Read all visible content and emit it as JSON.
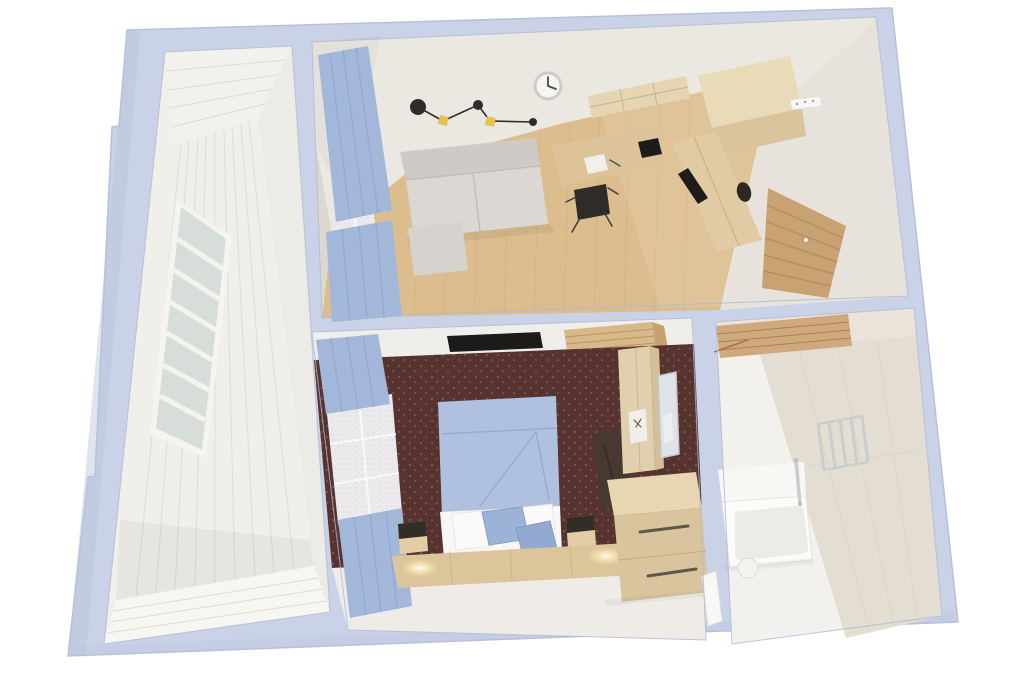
{
  "image": {
    "width": 1024,
    "height": 688,
    "kind": "3d-floorplan-dollhouse-render",
    "background": "#ffffff"
  },
  "colors": {
    "page_bg": "#ffffff",
    "outer_wall": "#c9d2e7",
    "outer_wall_shade": "#b9c3da",
    "hole_outline": "#aeb9d2",
    "balcony_base": "#f1efea",
    "balcony_ceiling": "#f3f1ed",
    "balcony_east_wall": "#ecebe6",
    "balcony_wall": "#f1efea",
    "balcony_floor": "#f7f6f3",
    "plank_line": "#dcd8d1",
    "window_frame": "#f5f4f1",
    "window_glass": "#d7ddd8",
    "window_slat": "#f4f3f0",
    "living_wall": "#ebe8e2",
    "living_wall_shade": "#dcd8d0",
    "living_east_wall": "#e7e3dc",
    "floor_wood": "#dcbd8e",
    "floor_line": "#c8a678",
    "sofa_back": "#cfcac6",
    "sofa_seat": "#dbd7d3",
    "sofa_shadow": "#bdb8b4",
    "ottoman": "#d6d2ce",
    "lamp_dark": "#2e2d2b",
    "lamp_yellow": "#e6c14b",
    "clock_face": "#f6f5f2",
    "clock_ring": "#cfccc6",
    "desk_wood": "#ddc399",
    "chair_dark": "#2f2b27",
    "item_black": "#1d1c1b",
    "notebook_white": "#f1f0ec",
    "shelf_wood": "#e6d5b2",
    "cabinet_top": "#eadbb8",
    "cabinet_front": "#d9c49c",
    "counter_wood": "#e0cba4",
    "door_wood": "#c9a273",
    "door_line": "#aa8155",
    "hook_white": "#f7f7f5",
    "bedroom_wall": "#f0eeea",
    "tv_black": "#1c1b1a",
    "slat_wood": "#d8b88a",
    "slat_wood_dark": "#c6a271",
    "slat_line": "#b99560",
    "carpet_base": "#57332f",
    "carpet_dot": "#82564e",
    "curtain_blue": "#a3b7da",
    "curtain_fold": "#8ba3cd",
    "lace_white": "#eceaed",
    "duvet_blue": "#afc1de",
    "duvet_fold": "#93a9cf",
    "sheet_white": "#f8f7f5",
    "pillow_white": "#fbfaf8",
    "pillow_blue": "#9cb2d7",
    "pillow_blue2": "#93aad0",
    "nightstand_wood": "#e2cda5",
    "nightstand_dark": "#332d28",
    "platform_wood": "#dcc59b",
    "glow_warm": "#fff6d8",
    "wardrobe_wood": "#e1d0ad",
    "wardrobe_side": "#d3c098",
    "mirror_glass": "#dde3e6",
    "mirror_frame": "#c2c7cb",
    "bag_dark": "#473931",
    "dresser_top": "#e7d6b1",
    "dresser_front": "#d9c49d",
    "handle_dark": "#5f574b",
    "bath_wall": "#e9e3da",
    "bath_wall_east": "#e4ddd2",
    "bath_floor": "#f3f1ed",
    "bath_shelf_wood": "#cfa87b",
    "bath_shelf_line": "#a9805a",
    "bath_accent_red": "#b2604a",
    "tub_white": "#fbfbf9",
    "tub_bench": "#f7f7f4",
    "tub_inner": "#ebebe8",
    "stool_white": "#f3f2ee",
    "chrome": "#c9cdd1",
    "bath_door_white": "#f8f8f6",
    "south_floor": "#efece7"
  },
  "scene": {
    "view": "top-down 3d cutaway of a one-bedroom apartment, walls periwinkle, no text labels",
    "rooms": [
      {
        "id": "balcony",
        "label": "balcony",
        "items": [
          "white-plank-walls",
          "louvered-window",
          "white-plank-floor"
        ]
      },
      {
        "id": "living-room",
        "label": "living-room-kitchen",
        "items": [
          "sofa",
          "ottoman",
          "wall-lamp-black-yellow",
          "wall-clock",
          "blue-curtains",
          "sheer-window",
          "desk",
          "desk-chair",
          "notebook",
          "black-box",
          "wall-shelves",
          "tall-cabinet",
          "kitchen-unit",
          "wood-floor"
        ]
      },
      {
        "id": "hallway",
        "label": "entrance-hall",
        "items": [
          "slatted-entrance-door",
          "coat-hook-rail",
          "floor-bag"
        ]
      },
      {
        "id": "bedroom",
        "label": "bedroom",
        "items": [
          "double-bed-blue-duvet",
          "white-pillows",
          "blue-pillows",
          "nightstands",
          "backlit-headboard-platform",
          "wall-tv",
          "wood-slat-panel",
          "blue-curtains",
          "sheer-window",
          "wardrobe",
          "mirror",
          "hook-panel",
          "dresser",
          "laundry-pile",
          "patterned-maroon-carpet"
        ]
      },
      {
        "id": "bathroom",
        "label": "bathroom",
        "items": [
          "bathtub",
          "tub-bench",
          "towel-radiator",
          "grab-bar",
          "round-stool",
          "wood-slat-shelf",
          "open-white-door",
          "beige-tile-walls"
        ]
      }
    ]
  }
}
